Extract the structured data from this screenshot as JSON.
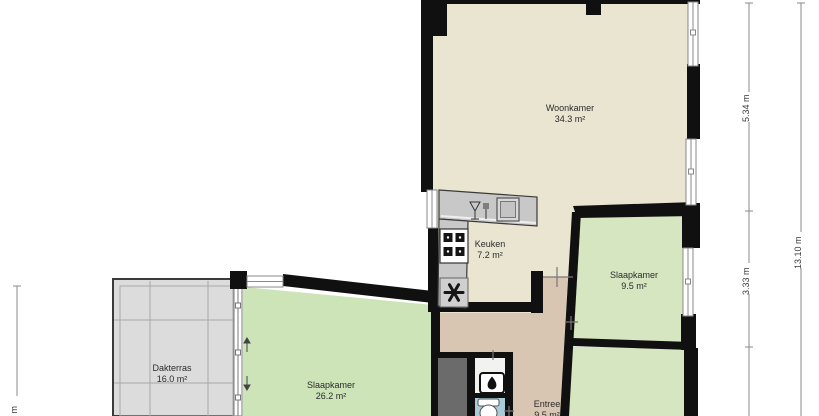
{
  "plan": {
    "rooms": [
      {
        "name": "Woonkamer",
        "area": "34.3 m²"
      },
      {
        "name": "Keuken",
        "area": "7.2 m²"
      },
      {
        "name": "Slaapkamer",
        "area": "9.5 m²"
      },
      {
        "name": "Slaapkamer",
        "area": "26.2 m²"
      },
      {
        "name": "Dakterras",
        "area": "16.0 m²"
      },
      {
        "name": "Entree",
        "area": "9.5 m²"
      }
    ],
    "dimension_labels": {
      "right_upper": "5.34 m",
      "right_middle": "3.33 m",
      "right_total": "13.10 m",
      "left_bottom_partial": "0 m"
    },
    "icons": [
      "stove-icon",
      "ventilation-fan-icon",
      "dishwasher-icon",
      "sink-icon",
      "boiler-flame-icon",
      "toilet-icon",
      "terrace-door-arrows-icon",
      "window",
      "chimney"
    ],
    "colors": {
      "wall": "#101010",
      "living_floor": "#e9e5d0",
      "bedroom_floor_right": "#d5e6c1",
      "bedroom_floor_left": "#cde3b8",
      "hall_floor": "#d8c6b2",
      "terrace_floor": "#dcdcdc",
      "toilet_floor": "#accbd9",
      "closet_floor": "#6b6b6b",
      "counter": "#c8c8c8",
      "dimension_line": "#8a8a8a"
    }
  }
}
